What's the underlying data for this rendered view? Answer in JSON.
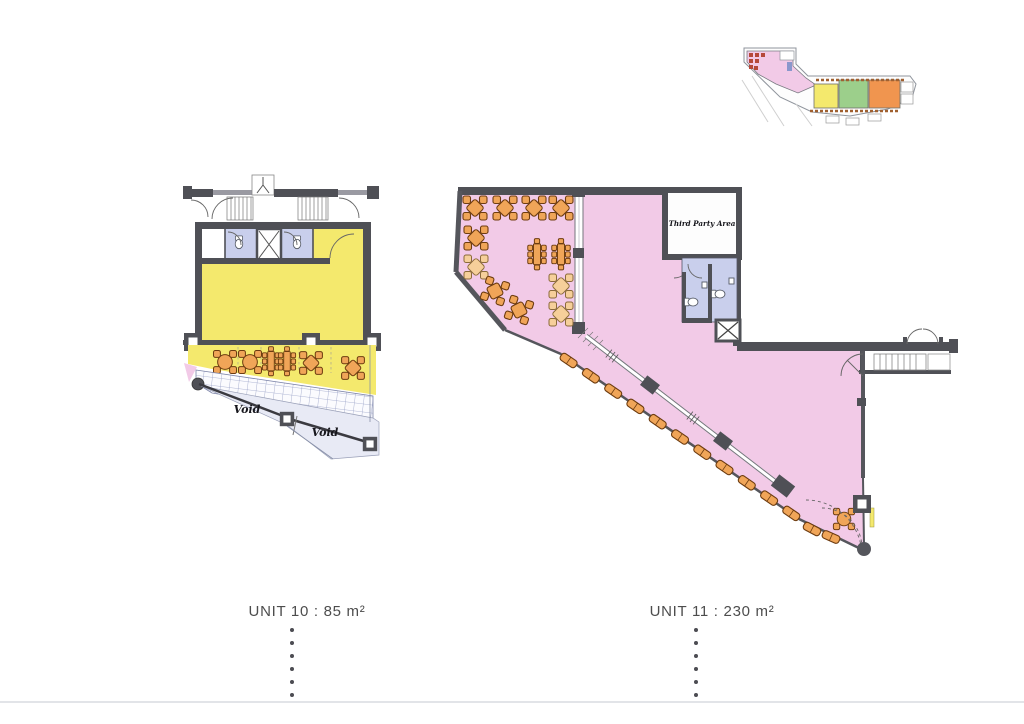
{
  "sheet": {
    "unit10": {
      "label": "UNIT 10 : 85 m²",
      "area_value": "85 m²",
      "void_label_1": "Void",
      "void_label_2": "Void"
    },
    "unit11": {
      "label": "UNIT 11 : 230 m²",
      "area_value": "230 m²",
      "third_party_label": "Third Party Area"
    },
    "colors": {
      "unit10_fill": "#f4e96d",
      "unit11_fill": "#f2cae7",
      "furniture": "#f0a558",
      "furniture_light": "#f6cf9a",
      "wet_area": "#c9cfec",
      "wall": "#4f5056",
      "void_fill": "#e8eaf5",
      "key_green": "#9ccf8b",
      "key_orange": "#f0954f",
      "key_red": "#b5483a",
      "label_text": "#4d4d4d"
    }
  }
}
